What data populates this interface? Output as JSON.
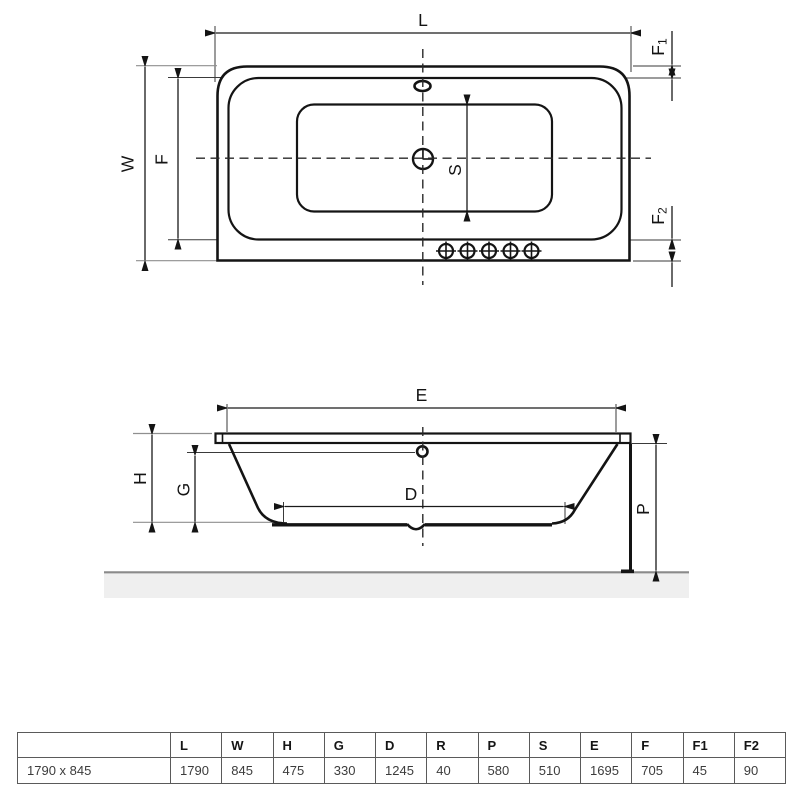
{
  "top_view": {
    "l": "L",
    "w": "W",
    "f": "F",
    "s": "S",
    "f1_base": "F",
    "f1_sub": "1",
    "f2_base": "F",
    "f2_sub": "2"
  },
  "side_view": {
    "e": "E",
    "h": "H",
    "g": "G",
    "d": "D",
    "p": "P"
  },
  "table": {
    "headers": [
      "",
      "L",
      "W",
      "H",
      "G",
      "D",
      "R",
      "P",
      "S",
      "E",
      "F",
      "F1",
      "F2"
    ],
    "row_label": "1790 x 845",
    "values": [
      "1790",
      "845",
      "475",
      "330",
      "1245",
      "40",
      "580",
      "510",
      "1695",
      "705",
      "45",
      "90"
    ]
  },
  "colors": {
    "line": "#141414",
    "floor_fill": "#efefef",
    "floor_line": "#8a8a8a"
  }
}
